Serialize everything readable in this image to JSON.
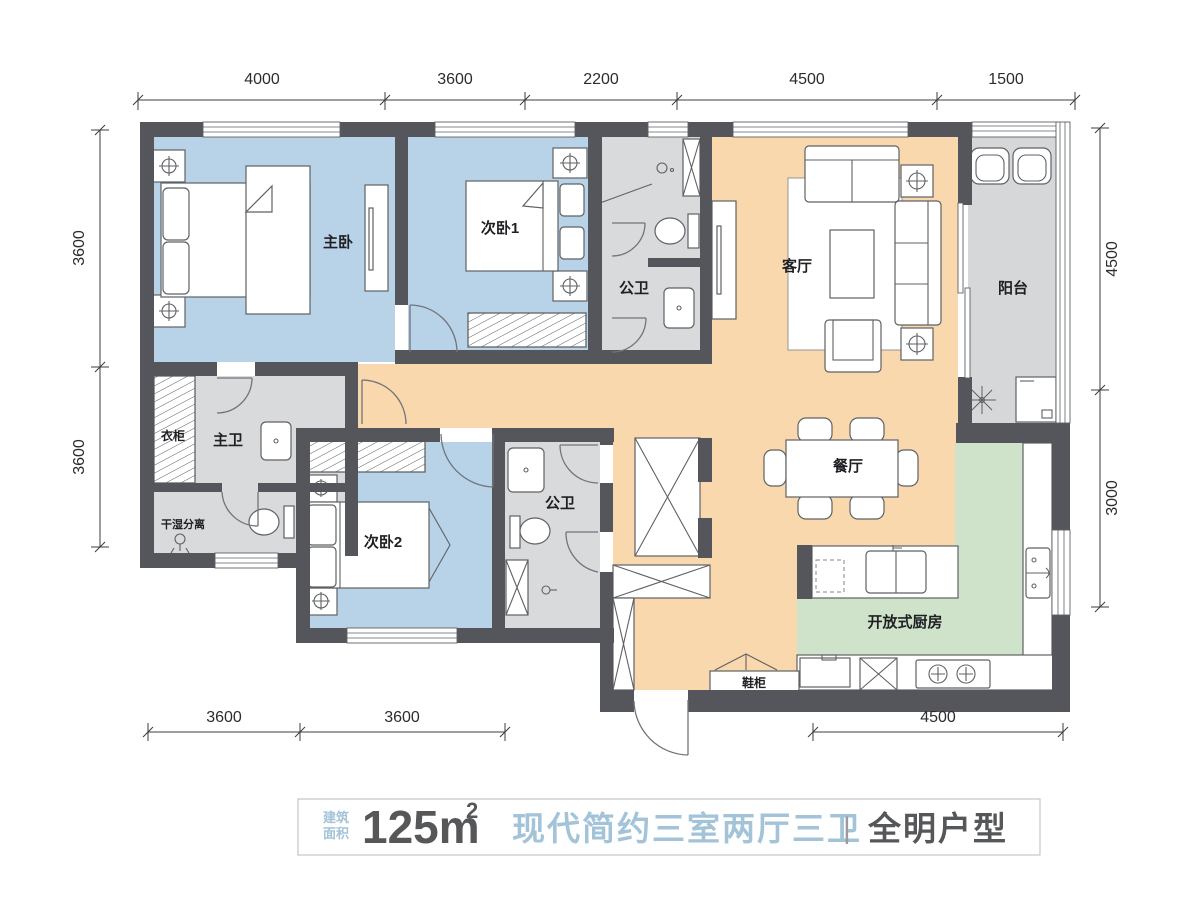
{
  "plan": {
    "rooms": {
      "master_bedroom": "主卧",
      "bedroom2": "次卧1",
      "bedroom3": "次卧2",
      "bath_public_top": "公卫",
      "bath_public_bottom": "公卫",
      "bath_master": "主卫",
      "living": "客厅",
      "dining": "餐厅",
      "balcony": "阳台",
      "wardrobe": "衣柜",
      "dry_wet": "干湿分离",
      "kitchen": "开放式厨房",
      "shoe_cabinet": "鞋柜"
    },
    "dims": {
      "top": [
        "4000",
        "3600",
        "2200",
        "4500",
        "1500"
      ],
      "left": [
        "3600",
        "3600"
      ],
      "right": [
        "4500",
        "3000"
      ],
      "bottom_left": [
        "3600",
        "3600"
      ],
      "bottom_right": [
        "4500"
      ]
    }
  },
  "caption": {
    "area_label_top": "建筑",
    "area_label_bottom": "面积",
    "area_value": "125m",
    "area_sup": "2",
    "style_title": "现代简约三室两厅三卫",
    "separator": "|",
    "subtitle": "全明户型"
  },
  "colors": {
    "wall": "#54565c",
    "bedroom": "#b8d2e8",
    "living": "#f8d8ac",
    "kitchen": "#cfe2ca",
    "bath": "#d9dadb",
    "balcony": "#d6d7d8",
    "accent": "#a3c3d8",
    "darktext": "#565759"
  }
}
